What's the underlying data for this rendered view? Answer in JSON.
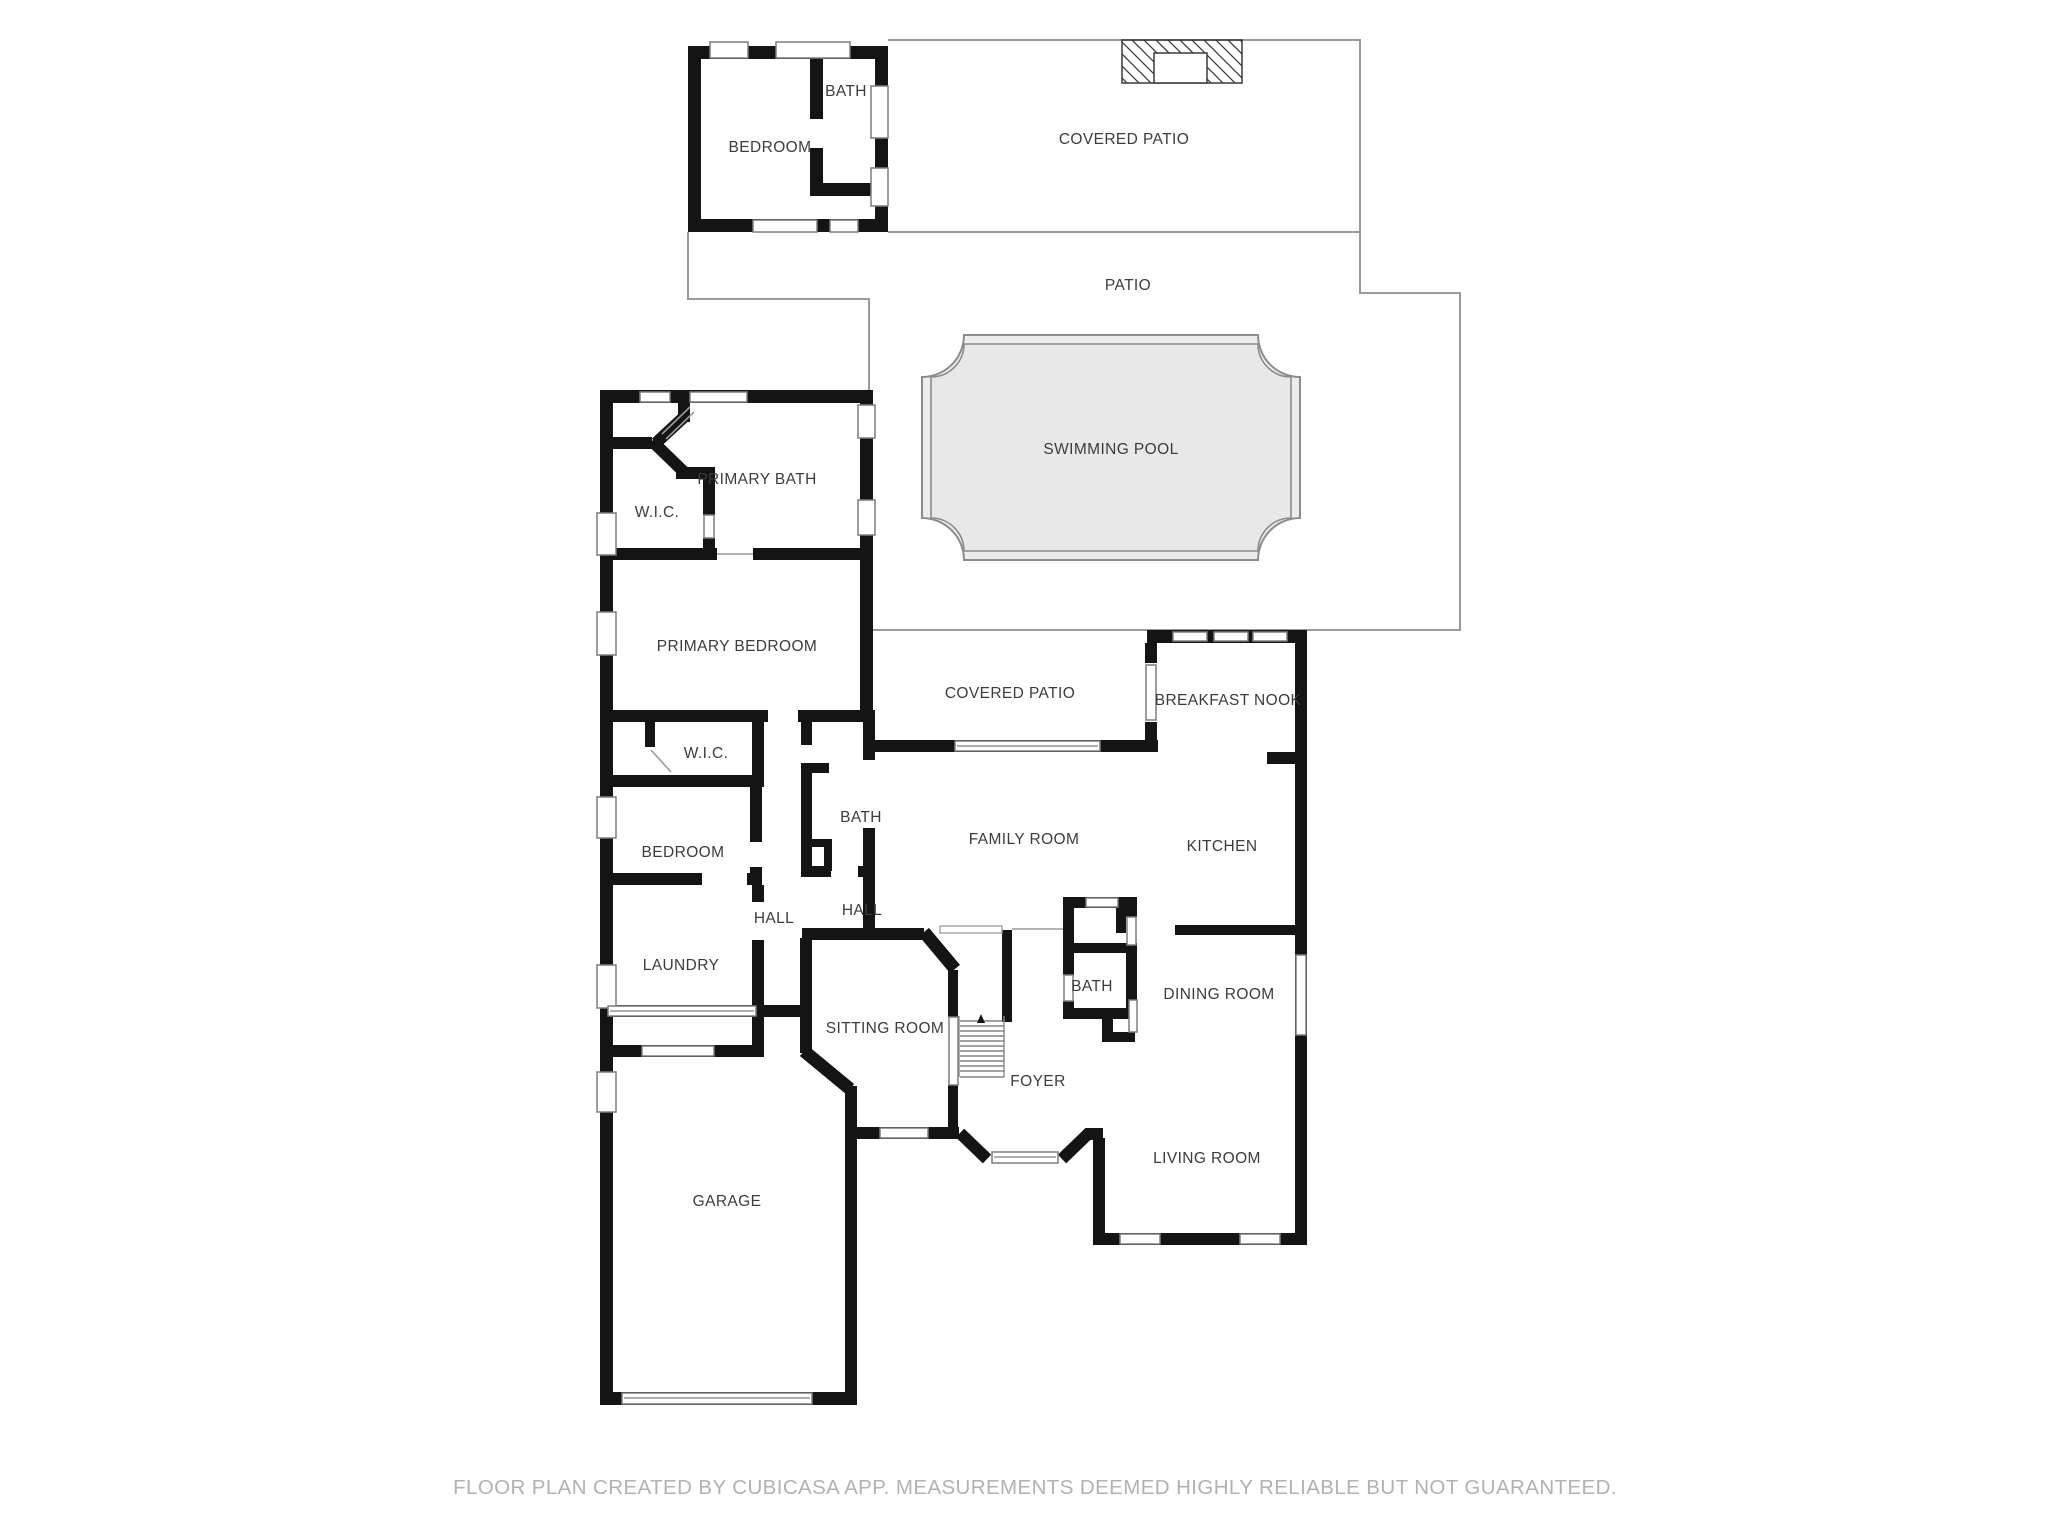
{
  "footer": {
    "disclaimer": "FLOOR PLAN CREATED BY CUBICASA APP. MEASUREMENTS DEEMED HIGHLY RELIABLE BUT NOT GUARANTEED."
  },
  "colors": {
    "wall": "#141414",
    "thin_line": "#9a9a9a",
    "window_stroke": "#7d7d7d",
    "pool_fill": "#ececec",
    "pool_inner_fill": "#e8e8e8",
    "pool_stroke": "#8c8c8c",
    "label_text": "#3c3c3c",
    "footer_text": "#b2b2b2",
    "background": "#ffffff"
  },
  "rooms": [
    {
      "id": "bedroom-top",
      "label": "BEDROOM"
    },
    {
      "id": "bath-top",
      "label": "BATH"
    },
    {
      "id": "covered-patio-top",
      "label": "COVERED PATIO"
    },
    {
      "id": "patio",
      "label": "PATIO"
    },
    {
      "id": "swimming-pool",
      "label": "SWIMMING POOL"
    },
    {
      "id": "primary-bath",
      "label": "PRIMARY BATH"
    },
    {
      "id": "wic-primary",
      "label": "W.I.C."
    },
    {
      "id": "primary-bedroom",
      "label": "PRIMARY BEDROOM"
    },
    {
      "id": "covered-patio-mid",
      "label": "COVERED PATIO"
    },
    {
      "id": "breakfast-nook",
      "label": "BREAKFAST NOOK"
    },
    {
      "id": "wic-2",
      "label": "W.I.C."
    },
    {
      "id": "bath-hall",
      "label": "BATH"
    },
    {
      "id": "family-room",
      "label": "FAMILY ROOM"
    },
    {
      "id": "kitchen",
      "label": "KITCHEN"
    },
    {
      "id": "bedroom-2",
      "label": "BEDROOM"
    },
    {
      "id": "hall-left",
      "label": "HALL"
    },
    {
      "id": "hall-right",
      "label": "HALL"
    },
    {
      "id": "laundry",
      "label": "LAUNDRY"
    },
    {
      "id": "bath-foyer",
      "label": "BATH"
    },
    {
      "id": "dining-room",
      "label": "DINING ROOM"
    },
    {
      "id": "sitting-room",
      "label": "SITTING ROOM"
    },
    {
      "id": "foyer",
      "label": "FOYER"
    },
    {
      "id": "living-room",
      "label": "LIVING ROOM"
    },
    {
      "id": "garage",
      "label": "GARAGE"
    }
  ]
}
